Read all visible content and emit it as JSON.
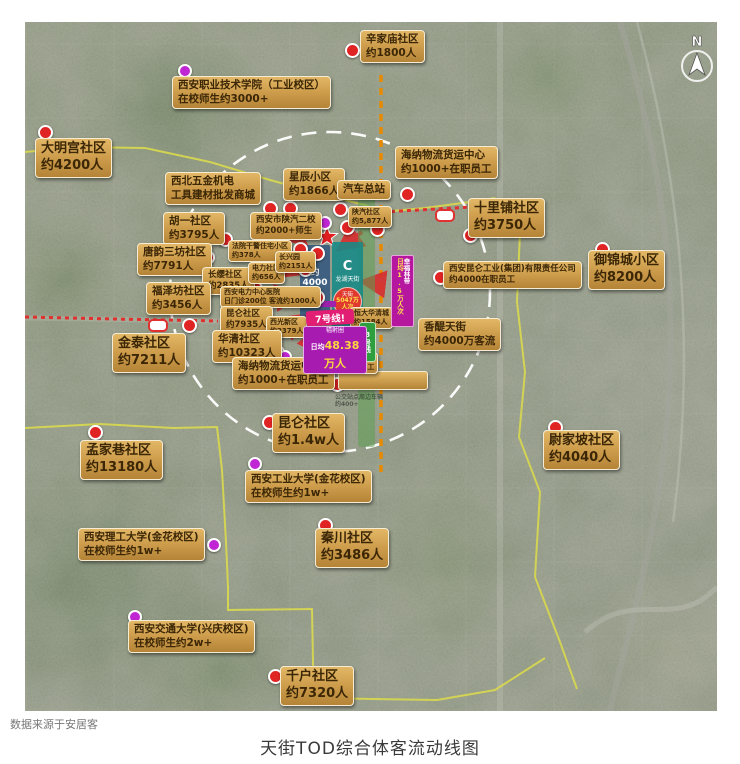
{
  "page": {
    "source_note": "数据来源于安居客",
    "title": "天街TOD综合体客流动线图"
  },
  "compass": {
    "letter": "N"
  },
  "colors": {
    "gold_top": "#e2b765",
    "gold_bottom": "#b58437",
    "label_text": "#3b2606",
    "red_dot": "#e02424",
    "magenta_dot": "#c026d3",
    "coverage_circle": "#ffffff",
    "metro_orange": "#e68a00",
    "metro_red": "#e03030",
    "boundary_yellow": "#d9d94e",
    "arrow_red": "#d62f2f",
    "banner_purple": "#b5179e",
    "line8_green": "#2e9e3e",
    "line7_pink": "#e11d74",
    "radius_purple": "#a81bb0",
    "value_yellow": "#ffd83d",
    "block_blue": "rgba(52,88,128,0.88)",
    "block_teal": "rgba(24,138,134,0.9)"
  },
  "center": {
    "left_block": {
      "value": "约4000人"
    },
    "right_block": {
      "logo": "C",
      "brand": "龙湖天街",
      "badge_top": "天街",
      "badge_value": "5047万人次"
    },
    "banner": {
      "name": "幸福林带",
      "value": "日均1.5万人次"
    },
    "line7": {
      "label": "7号线!"
    },
    "line8": {
      "label": "8号线"
    },
    "radius_badge": {
      "title": "辐射圈",
      "label": "日均",
      "value": "48.38万人"
    },
    "faint_note": {
      "line1": "公交站点周边车辆",
      "line2": "约400+"
    }
  },
  "map": {
    "labels": [
      {
        "id": "xinjiamiao",
        "x": 335,
        "y": 8,
        "size": "md",
        "lines": [
          "辛家庙社区",
          "约1800人"
        ]
      },
      {
        "id": "zhiye-college",
        "x": 147,
        "y": 54,
        "size": "md",
        "lines": [
          "西安职业技术学院（工业校区）",
          "在校师生约3000+"
        ]
      },
      {
        "id": "daminggong",
        "x": 10,
        "y": 116,
        "size": "lg",
        "lines": [
          "大明宫社区",
          "约4200人"
        ]
      },
      {
        "id": "haina-north",
        "x": 370,
        "y": 124,
        "size": "md",
        "lines": [
          "海纳物流货运中心",
          "约1000+在职员工"
        ]
      },
      {
        "id": "wujin-mall",
        "x": 140,
        "y": 150,
        "size": "md",
        "lines": [
          "西北五金机电",
          "工具建材批发商城"
        ]
      },
      {
        "id": "xingchen",
        "x": 258,
        "y": 146,
        "size": "md",
        "lines": [
          "星辰小区",
          "约1866人"
        ]
      },
      {
        "id": "qiche-zongzhan",
        "x": 312,
        "y": 158,
        "size": "md",
        "lines": [
          "汽车总站"
        ]
      },
      {
        "id": "shilipu",
        "x": 443,
        "y": 176,
        "size": "lg",
        "lines": [
          "十里铺社区",
          "约3750人"
        ]
      },
      {
        "id": "yujincheng",
        "x": 563,
        "y": 228,
        "size": "lg",
        "lines": [
          "御锦城小区",
          "约8200人"
        ]
      },
      {
        "id": "shanqi-shequ",
        "x": 323,
        "y": 184,
        "size": "xs",
        "lines": [
          "陕汽社区",
          "约5,877人"
        ]
      },
      {
        "id": "huyi",
        "x": 138,
        "y": 190,
        "size": "md",
        "lines": [
          "胡一社区",
          "约3795人"
        ]
      },
      {
        "id": "shanqi-erxiao",
        "x": 225,
        "y": 190,
        "size": "sm",
        "lines": [
          "西安市陕汽二校",
          "约2000+师生"
        ]
      },
      {
        "id": "tangyun",
        "x": 112,
        "y": 221,
        "size": "md",
        "lines": [
          "唐韵三坊社区",
          "约7791人"
        ]
      },
      {
        "id": "fayuan",
        "x": 203,
        "y": 218,
        "size": "xs",
        "lines": [
          "法院干警住宅小区",
          "约378人"
        ]
      },
      {
        "id": "changying",
        "x": 177,
        "y": 245,
        "size": "sm",
        "lines": [
          "长缨社区",
          "约2835人"
        ]
      },
      {
        "id": "dianli-shequ",
        "x": 223,
        "y": 240,
        "size": "xs",
        "lines": [
          "电力社区",
          "约656人"
        ]
      },
      {
        "id": "changxingyuan",
        "x": 250,
        "y": 229,
        "size": "xs",
        "lines": [
          "长兴园",
          "约2151人"
        ]
      },
      {
        "id": "fuzefang",
        "x": 121,
        "y": 260,
        "size": "md",
        "lines": [
          "福泽坊社区",
          "约3456人"
        ]
      },
      {
        "id": "dianli-hospital",
        "x": 195,
        "y": 264,
        "size": "xs",
        "lines": [
          "西安电力中心医院",
          "日门诊200位 客流约1000人"
        ]
      },
      {
        "id": "kunlun-7935",
        "x": 195,
        "y": 284,
        "size": "sm",
        "lines": [
          "昆仑社区",
          "约7935人"
        ]
      },
      {
        "id": "xiguang-xinqu",
        "x": 241,
        "y": 294,
        "size": "xs",
        "lines": [
          "西光新区",
          "约2379人"
        ]
      },
      {
        "id": "jintai",
        "x": 87,
        "y": 311,
        "size": "lg",
        "lines": [
          "金泰社区",
          "约7211人"
        ]
      },
      {
        "id": "huaqing",
        "x": 187,
        "y": 308,
        "size": "md",
        "lines": [
          "华清社区",
          "约10323人"
        ]
      },
      {
        "id": "haina-center",
        "x": 207,
        "y": 335,
        "size": "md",
        "lines": [
          "海纳物流货运中心",
          "约1000+在职员工"
        ]
      },
      {
        "id": "hengda",
        "x": 325,
        "y": 285,
        "size": "xs",
        "lines": [
          "恒大华清城",
          "约1584人"
        ]
      },
      {
        "id": "xiguang-group",
        "x": 285,
        "y": 330,
        "size": "xs",
        "lines": [
          "西安西光集团",
          "约3600+在职员工"
        ]
      },
      {
        "id": "kunlun-gongye",
        "x": 418,
        "y": 239,
        "size": "sm",
        "lines": [
          "西安昆仑工业(集团)有限责任公司",
          "约4000在职员工"
        ]
      },
      {
        "id": "xiangti",
        "x": 393,
        "y": 296,
        "size": "md",
        "lines": [
          "香醍天街",
          "约4000万客流"
        ]
      },
      {
        "id": "kunlun-14w",
        "x": 247,
        "y": 391,
        "size": "lg",
        "lines": [
          "昆仑社区",
          "约1.4w人"
        ]
      },
      {
        "id": "mengjiaxiang",
        "x": 55,
        "y": 418,
        "size": "lg",
        "lines": [
          "孟家巷社区",
          "约13180人"
        ]
      },
      {
        "id": "gongye-univ",
        "x": 220,
        "y": 448,
        "size": "md",
        "lines": [
          "西安工业大学(金花校区)",
          "在校师生约1w+"
        ]
      },
      {
        "id": "weijiapo",
        "x": 518,
        "y": 408,
        "size": "lg",
        "lines": [
          "尉家坡社区",
          "约4040人"
        ]
      },
      {
        "id": "ligong-univ",
        "x": 53,
        "y": 506,
        "size": "md",
        "lines": [
          "西安理工大学(金花校区)",
          "在校师生约1w+"
        ]
      },
      {
        "id": "qinchuan",
        "x": 290,
        "y": 506,
        "size": "lg",
        "lines": [
          "秦川社区",
          "约3486人"
        ]
      },
      {
        "id": "jiaoda",
        "x": 103,
        "y": 598,
        "size": "md",
        "lines": [
          "西安交通大学(兴庆校区)",
          "在校师生约2w+"
        ]
      },
      {
        "id": "qianhu",
        "x": 255,
        "y": 644,
        "size": "lg",
        "lines": [
          "千户社区",
          "约7320人"
        ]
      }
    ],
    "dots": [
      {
        "x": 320,
        "y": 21,
        "c": "red"
      },
      {
        "x": 13,
        "y": 103,
        "c": "red"
      },
      {
        "x": 375,
        "y": 165,
        "c": "red"
      },
      {
        "x": 238,
        "y": 179,
        "c": "red"
      },
      {
        "x": 258,
        "y": 179,
        "c": "red"
      },
      {
        "x": 308,
        "y": 180,
        "c": "red"
      },
      {
        "x": 315,
        "y": 198,
        "c": "red"
      },
      {
        "x": 193,
        "y": 210,
        "c": "red"
      },
      {
        "x": 438,
        "y": 206,
        "c": "red"
      },
      {
        "x": 570,
        "y": 220,
        "c": "red"
      },
      {
        "x": 175,
        "y": 228,
        "c": "red"
      },
      {
        "x": 268,
        "y": 220,
        "c": "red"
      },
      {
        "x": 285,
        "y": 224,
        "c": "red"
      },
      {
        "x": 273,
        "y": 240,
        "c": "red"
      },
      {
        "x": 210,
        "y": 258,
        "c": "red"
      },
      {
        "x": 223,
        "y": 259,
        "c": "red"
      },
      {
        "x": 285,
        "y": 268,
        "c": "red"
      },
      {
        "x": 157,
        "y": 296,
        "c": "red"
      },
      {
        "x": 205,
        "y": 298,
        "c": "red"
      },
      {
        "x": 230,
        "y": 308,
        "c": "red"
      },
      {
        "x": 313,
        "y": 308,
        "c": "red"
      },
      {
        "x": 245,
        "y": 323,
        "c": "red"
      },
      {
        "x": 285,
        "y": 323,
        "c": "red"
      },
      {
        "x": 305,
        "y": 355,
        "c": "red"
      },
      {
        "x": 408,
        "y": 248,
        "c": "red"
      },
      {
        "x": 63,
        "y": 403,
        "c": "red"
      },
      {
        "x": 237,
        "y": 393,
        "c": "red"
      },
      {
        "x": 523,
        "y": 398,
        "c": "red"
      },
      {
        "x": 293,
        "y": 496,
        "c": "red"
      },
      {
        "x": 243,
        "y": 647,
        "c": "red"
      },
      {
        "x": 345,
        "y": 200,
        "c": "red"
      },
      {
        "x": 153,
        "y": 42,
        "c": "magenta"
      },
      {
        "x": 293,
        "y": 194,
        "c": "magenta"
      },
      {
        "x": 253,
        "y": 328,
        "c": "magenta"
      },
      {
        "x": 223,
        "y": 435,
        "c": "magenta"
      },
      {
        "x": 182,
        "y": 516,
        "c": "magenta"
      },
      {
        "x": 103,
        "y": 588,
        "c": "magenta"
      }
    ],
    "stations": [
      {
        "x": 123,
        "y": 297
      },
      {
        "x": 410,
        "y": 187
      }
    ]
  }
}
